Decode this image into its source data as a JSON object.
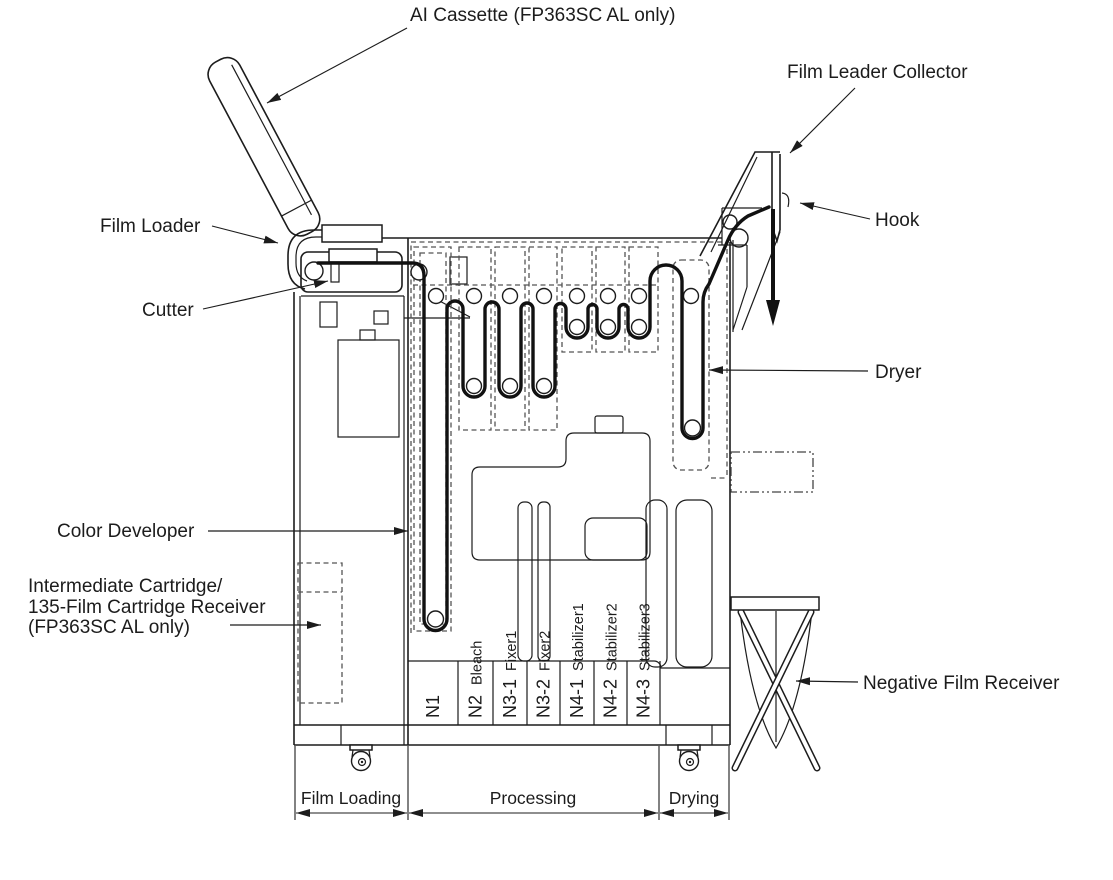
{
  "diagram": {
    "title": "FP363SC film processor side-view diagram",
    "labels": {
      "ai_cassette": "AI Cassette (FP363SC AL only)",
      "film_leader_collector": "Film Leader Collector",
      "hook": "Hook",
      "film_loader": "Film Loader",
      "cutter": "Cutter",
      "dryer": "Dryer",
      "color_developer": "Color Developer",
      "intermediate_line1": "Intermediate Cartridge/",
      "intermediate_line2": "135-Film Cartridge Receiver",
      "intermediate_line3": "(FP363SC AL only)",
      "negative_film_receiver": "Negative Film Receiver"
    },
    "tanks": [
      {
        "code": "N1",
        "name": ""
      },
      {
        "code": "N2",
        "name": "Bleach"
      },
      {
        "code": "N3-1",
        "name": "Fixer1"
      },
      {
        "code": "N3-2",
        "name": "Fixer2"
      },
      {
        "code": "N4-1",
        "name": "Stabilizer1"
      },
      {
        "code": "N4-2",
        "name": "Stabilizer2"
      },
      {
        "code": "N4-3",
        "name": "Stabilizer3"
      }
    ],
    "sections": [
      {
        "label": "Film Loading"
      },
      {
        "label": "Processing"
      },
      {
        "label": "Drying"
      }
    ],
    "colors": {
      "line": "#1c1c1c",
      "background": "#ffffff"
    }
  }
}
